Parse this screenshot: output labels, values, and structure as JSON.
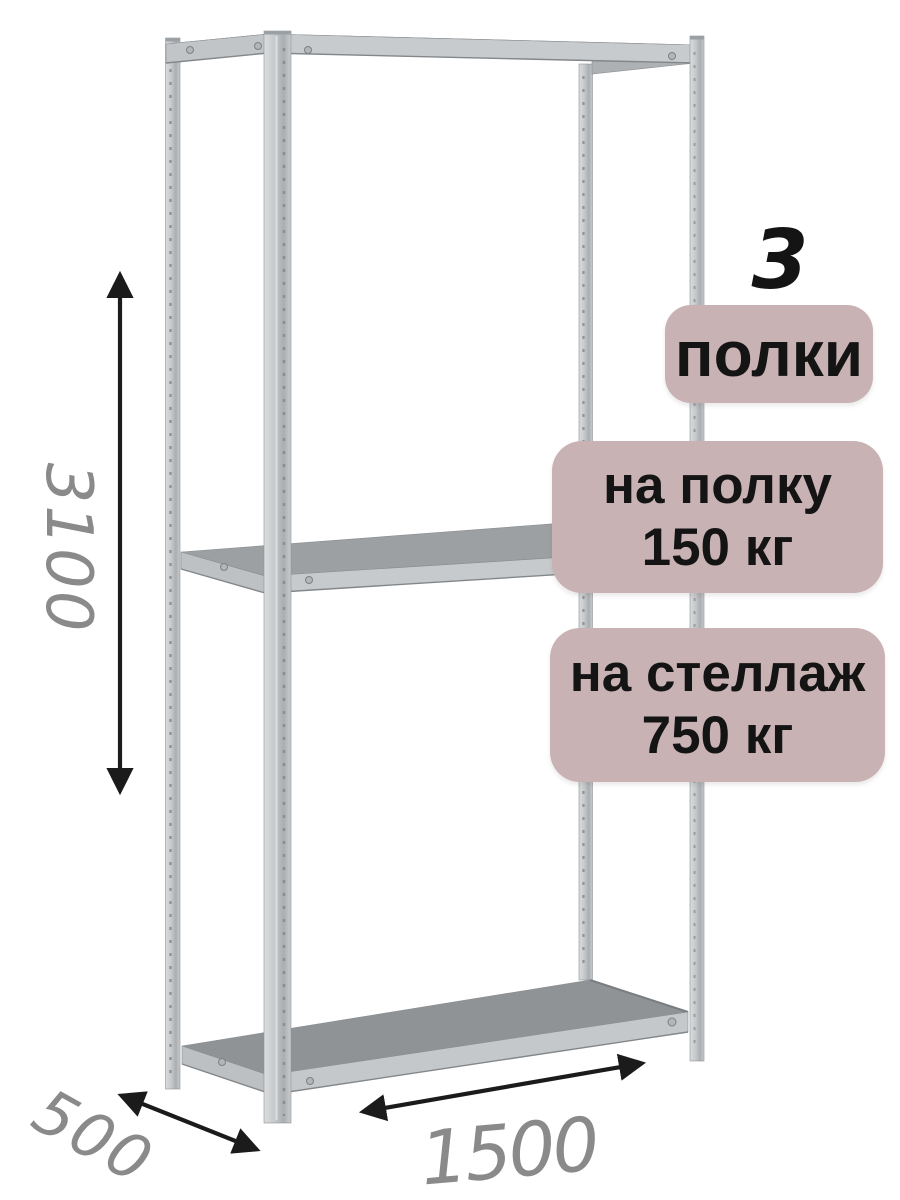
{
  "annotations": {
    "shelf_count_number": "3",
    "shelf_count_label": "полки",
    "per_shelf_load": {
      "line1": "на полку",
      "line2": "150 кг"
    },
    "per_rack_load": {
      "line1": "на стеллаж",
      "line2": "750 кг"
    },
    "dimensions": {
      "height": "3100",
      "depth": "500",
      "width": "1500"
    }
  },
  "colors": {
    "badge_bg": "#c9b2b3",
    "badge_text": "#141414",
    "dim_number": "#8a8a8a",
    "arrow": "#1b1b1b",
    "metal_light": "#d5d7d8",
    "metal_mid": "#c6c9cb",
    "metal_dark": "#a0a4a7",
    "shelf_top": "#8f9395",
    "background": "#ffffff"
  }
}
